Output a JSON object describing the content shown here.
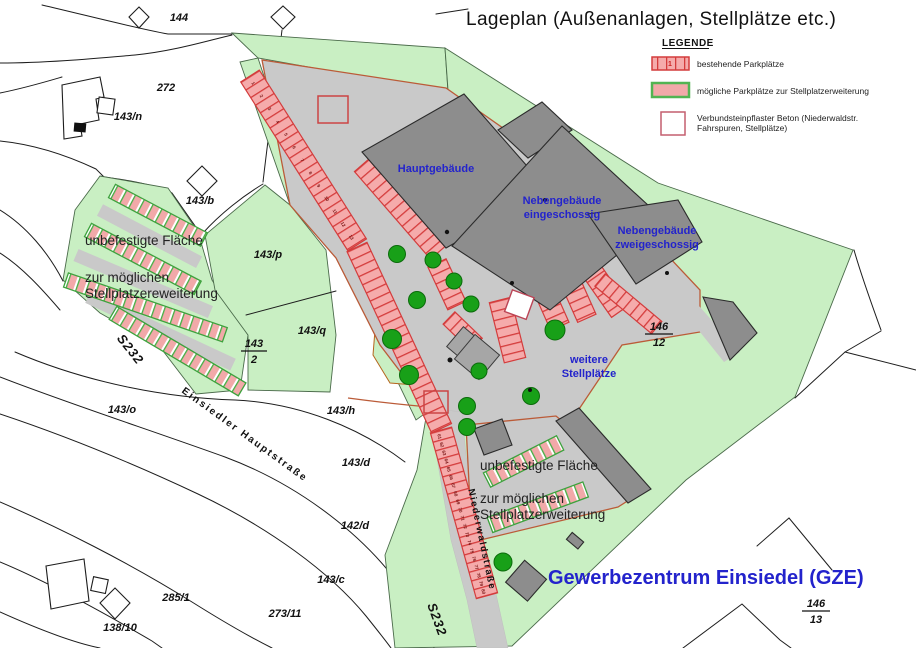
{
  "title": "Lageplan (Außenanlagen, Stellplätze etc.)",
  "legend": {
    "heading": "LEGENDE",
    "existing_label": "bestehende Parkplätze",
    "existing_swatch_text": "1",
    "possible_label": "mögliche Parkplätze zur Stellplatzerweiterung",
    "paver_label_line1": "Verbundsteinpflaster Beton (Niederwaldstr.",
    "paver_label_line2": "Fahrspuren, Stellplätze)"
  },
  "labels": {
    "hauptgebaeude": "Hauptgebäude",
    "nebengebaeude1_line1": "Nebengebäude",
    "nebengebaeude1_line2": "eingeschossig",
    "nebengebaeude2_line1": "Nebengebäude",
    "nebengebaeude2_line2": "zweigeschossig",
    "weitere_line1": "weitere",
    "weitere_line2": "Stellplätze",
    "area_left_line1": "unbefestigte Fläche",
    "area_left_line2": "zur möglichen",
    "area_left_line3": "Stellplatzereweiterung",
    "area_bottom_line1": "unbefestigte Fläche",
    "area_bottom_line2": "zur möglichen",
    "area_bottom_line3": "Stellplatzerweiterung",
    "site": "Gewerbezentrum Einsiedel (GZE)"
  },
  "streets": {
    "hauptstrasse": "Einsiedler Hauptstraße",
    "niederwaldstrasse": "Niederwaldstraße",
    "s232_a": "S232",
    "s232_b": "S232"
  },
  "parcels": [
    {
      "text": "144"
    },
    {
      "text": "272"
    },
    {
      "text": "143/n"
    },
    {
      "text": "143/b"
    },
    {
      "text": "143/p"
    },
    {
      "text": "143/q"
    },
    {
      "text": "143/o"
    },
    {
      "text": "143/h"
    },
    {
      "text": "143/d"
    },
    {
      "text": "142/d"
    },
    {
      "text": "143/c"
    },
    {
      "text": "285/1"
    },
    {
      "text": "273/11"
    },
    {
      "text": "138/10"
    }
  ],
  "fractions": [
    {
      "top": "143",
      "bottom": "2"
    },
    {
      "top": "146",
      "bottom": "12"
    },
    {
      "top": "146",
      "bottom": "13"
    }
  ],
  "stalls": {
    "row_upper": [
      "1",
      "2",
      "3",
      "4",
      "5",
      "6",
      "7",
      "8",
      "9",
      "10",
      "11",
      "12",
      "13"
    ],
    "row_street": [
      "61",
      "62",
      "63",
      "64",
      "65",
      "66",
      "67",
      "68",
      "69",
      "70",
      "71",
      "72",
      "73",
      "74",
      "75",
      "76",
      "77",
      "78",
      "79",
      "80"
    ]
  },
  "colors": {
    "green_area": "#c9efc3",
    "pavement": "#c9c9c9",
    "building": "#8d8d8d",
    "stall_fill": "#f5abab",
    "stall_red_border": "#d43c3c",
    "stall_green_border": "#3da23d",
    "tree_green": "#18a018",
    "label_blue": "#2323cc",
    "boundary_red_brown": "#bb5b38"
  }
}
